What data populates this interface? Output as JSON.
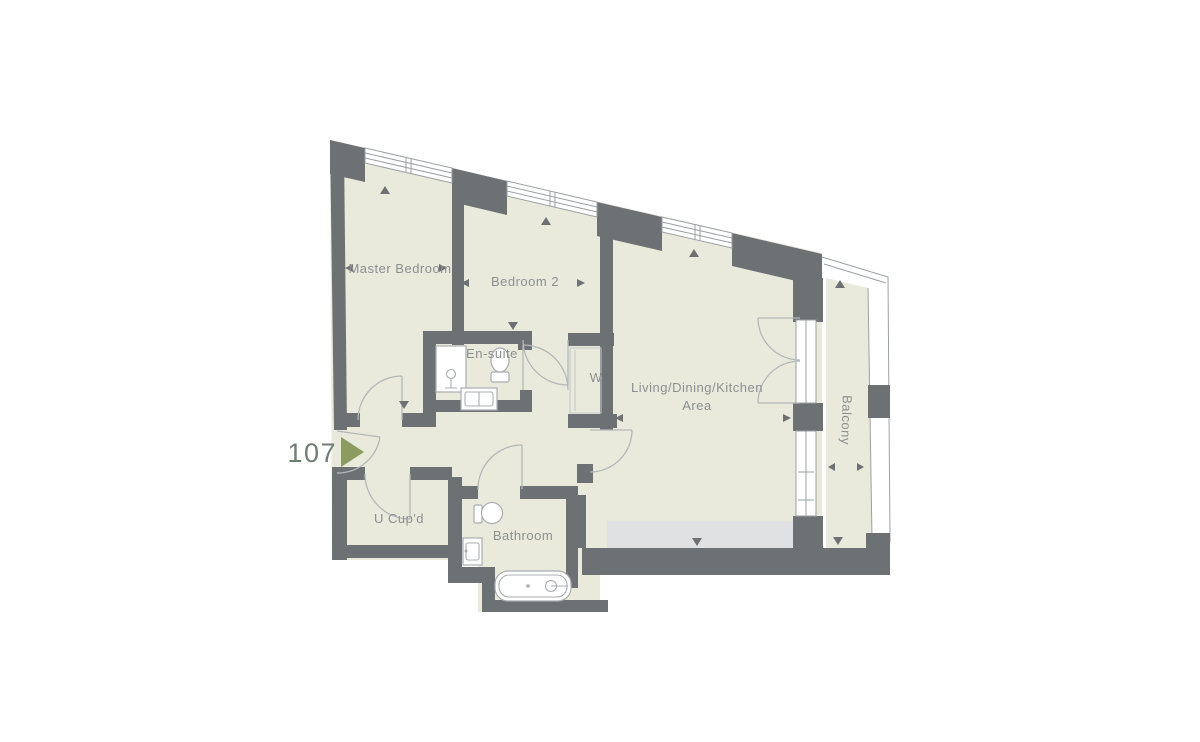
{
  "unit": {
    "number": "107"
  },
  "rooms": {
    "master_bedroom": {
      "label": "Master Bedroom"
    },
    "bedroom_2": {
      "label": "Bedroom 2"
    },
    "ensuite": {
      "label": "En-suite"
    },
    "wardrobe": {
      "label": "W"
    },
    "living": {
      "label_line1": "Living/Dining/Kitchen",
      "label_line2": "Area"
    },
    "balcony": {
      "label": "Balcony"
    },
    "utility_cupboard": {
      "label": "U Cup'd"
    },
    "bathroom": {
      "label": "Bathroom"
    }
  },
  "fixtures": {
    "ensuite": [
      "shower",
      "toilet",
      "basin"
    ],
    "bathroom": [
      "toilet",
      "basin",
      "bathtub"
    ]
  },
  "colors": {
    "wall": "#6e7173",
    "floor": "#e9eadb",
    "worktop": "#dfe1e3",
    "window_fill": "#ffffff",
    "outline": "#9ba0a3",
    "door_line": "#b4b8ba",
    "fixture_line": "#a9adb0",
    "label": "#8b8f91",
    "unit_number": "#6f7d72",
    "entrance_arrow": "#8c9c60",
    "closet_line": "#c3c7c9",
    "background": "#ffffff"
  }
}
